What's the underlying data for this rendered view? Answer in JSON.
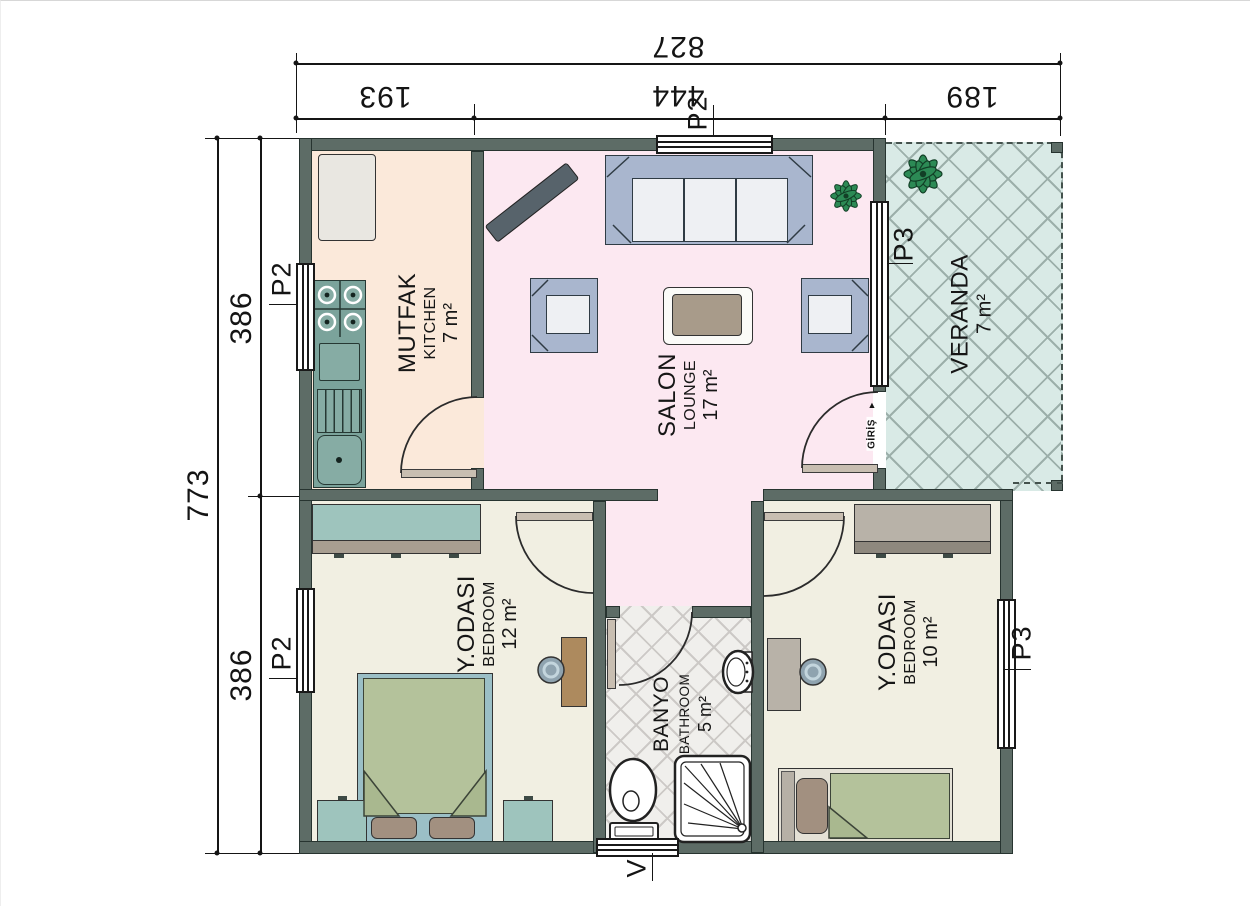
{
  "dimensions": {
    "top": {
      "total": "827",
      "seg1": "193",
      "seg2": "444",
      "seg3": "189",
      "window_label": "P2"
    },
    "left": {
      "total": "773",
      "seg1": "386",
      "seg2": "386",
      "kitchen_window_label": "P2",
      "bedroom_window_label": "P2"
    },
    "right": {
      "bedroom_window_label": "P3"
    },
    "veranda_window_label": "P3",
    "vent_label": "V"
  },
  "rooms": {
    "kitchen": {
      "name": "MUTFAK",
      "alt": "KITCHEN",
      "area": "7 m²"
    },
    "salon": {
      "name": "SALON",
      "alt": "LOUNGE",
      "area": "17 m²"
    },
    "veranda": {
      "name": "VERANDA",
      "area": "7 m²"
    },
    "bedroom1": {
      "name": "Y.ODASI",
      "alt": "BEDROOM",
      "area": "12 m²"
    },
    "bathroom": {
      "name": "BANYO",
      "alt": "BATHROOM",
      "area": "5 m²"
    },
    "bedroom2": {
      "name": "Y.ODASI",
      "alt": "BEDROOM",
      "area": "10 m²"
    }
  },
  "entrance": {
    "label": "GİRİŞ",
    "arrow": "▲"
  },
  "colors": {
    "wall": "#5d6c66",
    "kitchen_floor": "#fbe9da",
    "salon_floor": "#fce8f1",
    "bedroom_floor": "#f1efe2",
    "veranda_floor": "#d9eae6",
    "bathroom_floor": "#f0efec",
    "counter_teal": "#7ba39b",
    "cabinet_teal": "#9ec4bd",
    "sofa_periwinkle": "#a9b6ce",
    "bed_green": "#b4c29b",
    "pillow_taupe": "#a29080",
    "wood": "#ad8a5e",
    "taupe_furniture": "#b8b2a8",
    "plant_green": "#2c8a55",
    "door_leaf": "#c8beb1"
  }
}
